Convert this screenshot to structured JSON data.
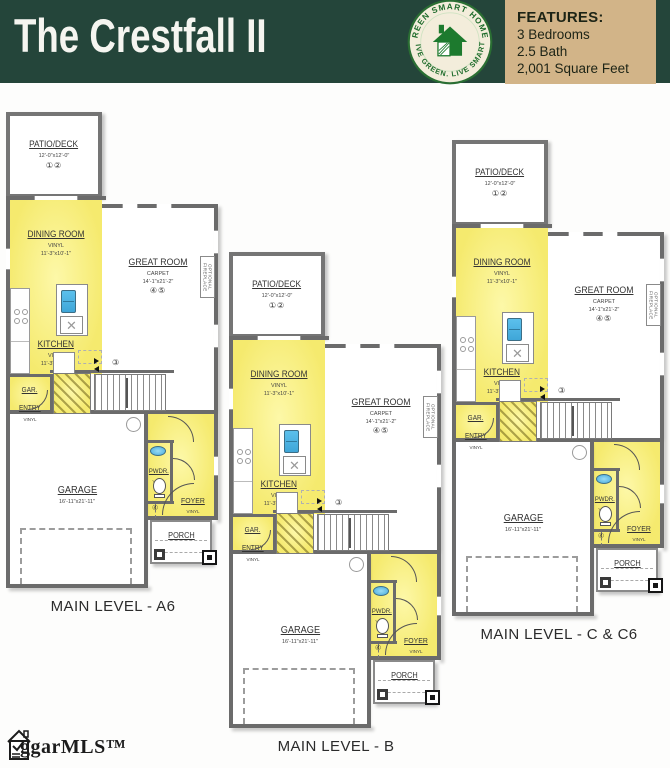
{
  "header": {
    "title": "The Crestfall II",
    "logo": {
      "arc_top": "GREEN SMART HOMES",
      "arc_bottom": "LIVE GREEN. LIVE SMART.",
      "house_icon": "green-house"
    },
    "features": {
      "heading": "FEATURES:",
      "items": [
        "3 Bedrooms",
        "2.5 Bath",
        "2,001 Square Feet"
      ]
    }
  },
  "plans": [
    {
      "id": "a6",
      "caption": "MAIN LEVEL - A6"
    },
    {
      "id": "b",
      "caption": "MAIN LEVEL - B"
    },
    {
      "id": "c-c6",
      "caption": "MAIN LEVEL - C & C6"
    }
  ],
  "rooms": {
    "patio": {
      "name": "PATIO/DECK",
      "dim": "12'-0\"x12'-0\"",
      "keys": "①②"
    },
    "dining": {
      "name": "DINING ROOM",
      "floor": "VINYL",
      "dim": "11'-3\"x10'-1\""
    },
    "great": {
      "name": "GREAT ROOM",
      "floor": "CARPET",
      "dim": "14'-1\"x21'-2\"",
      "keys": "④⑤"
    },
    "kitchen": {
      "name": "KITCHEN",
      "floor": "VINYL",
      "dim": "11'-3\"x12'-7\""
    },
    "gar_entry": {
      "name1": "GAR.",
      "name2": "ENTRY",
      "floor": "VINYL"
    },
    "garage": {
      "name": "GARAGE",
      "dim": "16'-11\"x21'-11\""
    },
    "pwdr": {
      "name": "PWDR.",
      "floor": "VINYL"
    },
    "foyer": {
      "name": "FOYER",
      "floor": "VINYL"
    },
    "porch": {
      "name": "PORCH"
    },
    "fireplace": {
      "label": "OPTIONAL FIREPLACE"
    },
    "stair_key": "③",
    "foyer_key": "④"
  },
  "watermark": {
    "text": "ggarMLS™"
  },
  "colors": {
    "header_green": "#24453a",
    "features_tan": "#d2b488",
    "highlight_yellow": "#f6ec75",
    "sink_blue": "#52b8e8",
    "wall_gray": "#6b6b6b"
  }
}
